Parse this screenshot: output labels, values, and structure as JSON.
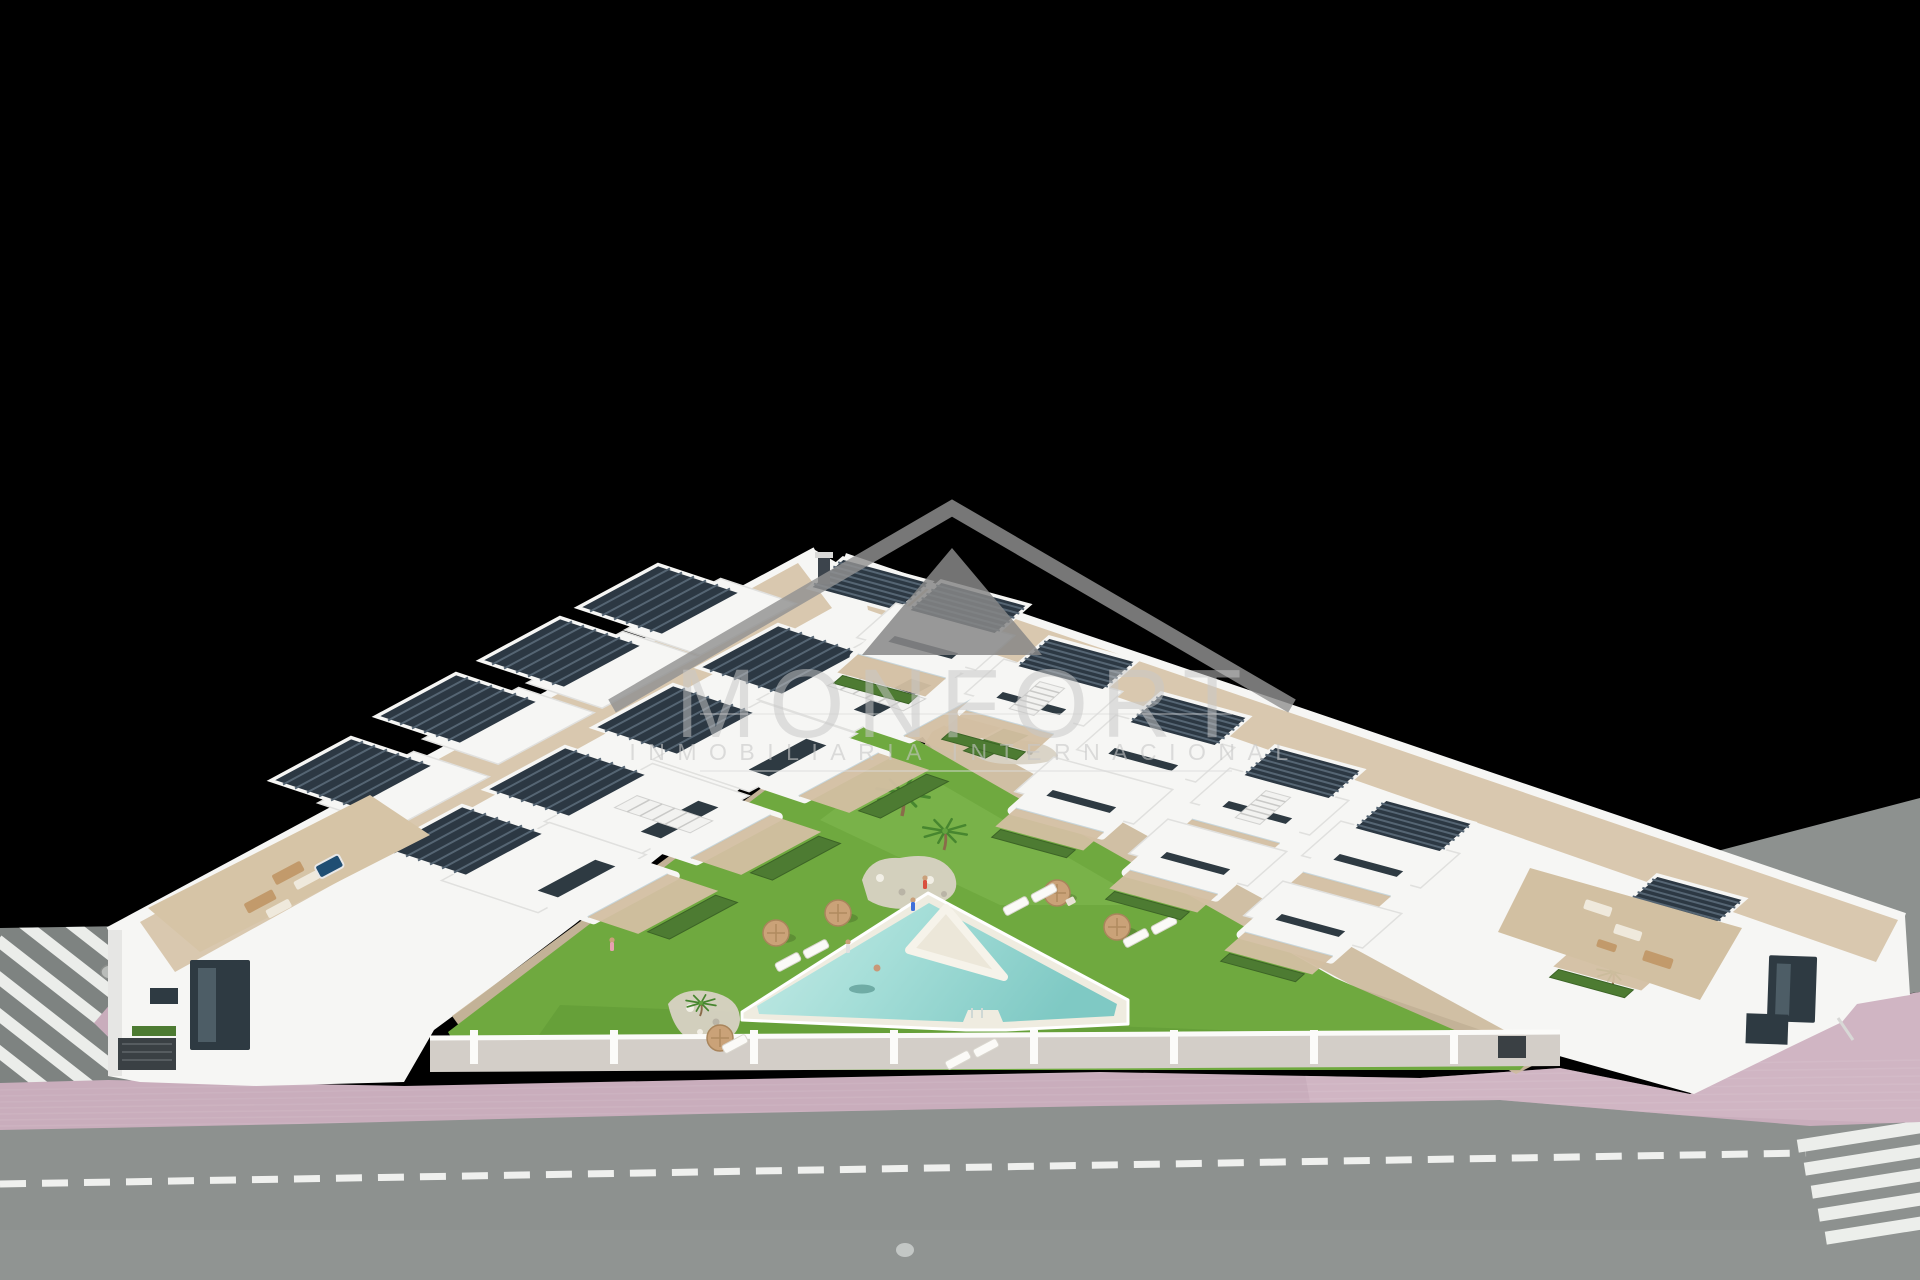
{
  "image": {
    "kind": "architectural-3d-render",
    "description": "Aerial render of a modern white residential complex: two wings of townhouses in a V layout around a communal lawn with a triangular swimming pool, fronted by a street with zebra crosswalks and a pink paved sidewalk, on a black background",
    "width": 1920,
    "height": 1280
  },
  "watermark": {
    "brand": "MONFORT",
    "tagline": "INMOBILIARIA INTERNACIONAL",
    "logo": "roof-chevron",
    "color": "#b5b5b5"
  },
  "palette": {
    "background": "#000000",
    "road": "#8d918f",
    "road_dark": "#7e8381",
    "road_marking": "#f4f6f3",
    "sidewalk": "#c9adbc",
    "sidewalk_light": "#d5bcc8",
    "lawn": "#6fa93f",
    "lawn_light": "#8cc25c",
    "lawn_dark": "#4e8a2c",
    "pool_water": "#7fc9c4",
    "pool_water_light": "#c6ebe6",
    "pool_deck": "#efece0",
    "building": "#f6f6f4",
    "building_shade": "#e6e6e4",
    "wall_gray": "#d3cec8",
    "terrace": "#d3bfa2",
    "pergola": "#2c3843",
    "pergola_slat": "#556573",
    "window_glass": "#2e3a42",
    "glass_rail": "#b8ccd4",
    "hedge": "#4d7b32",
    "umbrella": "#caa278",
    "rock": "#d8d2c4",
    "palm": "#47862f",
    "palm_trunk": "#8a6b4a",
    "hot_tub": "#1f4e73",
    "watermark_gray": "#c8c8c8"
  },
  "scene": {
    "crosswalks": 2,
    "road_manholes": 2,
    "umbrellas": 5,
    "sun_loungers": 9,
    "palm_trees": 4,
    "pergola_roofs": 15,
    "pool_shape": "triangular with inner island wedge",
    "people_visible": true
  }
}
